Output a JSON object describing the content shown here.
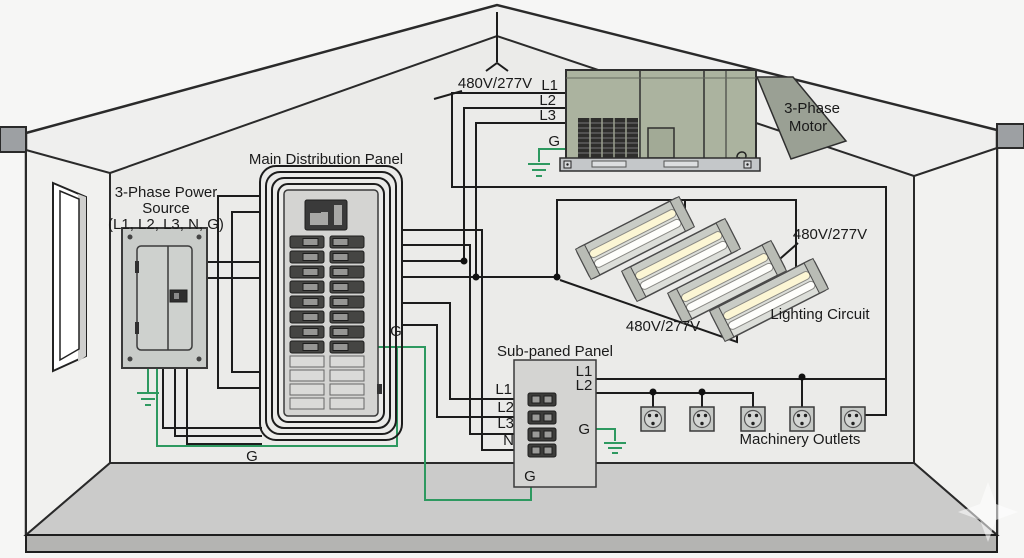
{
  "labels": {
    "voltage_top": "480V/277V",
    "voltage_lighting_right": "480V/277V",
    "voltage_lighting_bottom": "480V/277V",
    "lighting_circuit": "Lighting Circuit",
    "machinery_outlets": "Machinery Outlets",
    "main_panel_title": "Main Distribution Panel",
    "sub_panel_title": "Sub-paned Panel",
    "ground_bus": "G"
  },
  "power_source": {
    "title_line1": "3-Phase Power",
    "title_line2": "Source",
    "title_line3": "(L1, L2, L3, N, G)"
  },
  "motor": {
    "title_line1": "3-Phase",
    "title_line2": "Motor",
    "line1": "L1",
    "line2": "L2",
    "line3": "L3",
    "ground": "G"
  },
  "main_panel": {
    "ground": "G"
  },
  "sub_panel": {
    "input1": "L1",
    "input2": "L2",
    "input3": "L3",
    "input4": "N",
    "output1": "L1",
    "output2": "L2",
    "ground_side": "G",
    "ground_bottom": "G"
  },
  "colors": {
    "wire_black": "#1c1c1c",
    "ground_green": "#2e9960",
    "motor_body": "#abb39f",
    "panel_gray": "#d4d4d2"
  }
}
